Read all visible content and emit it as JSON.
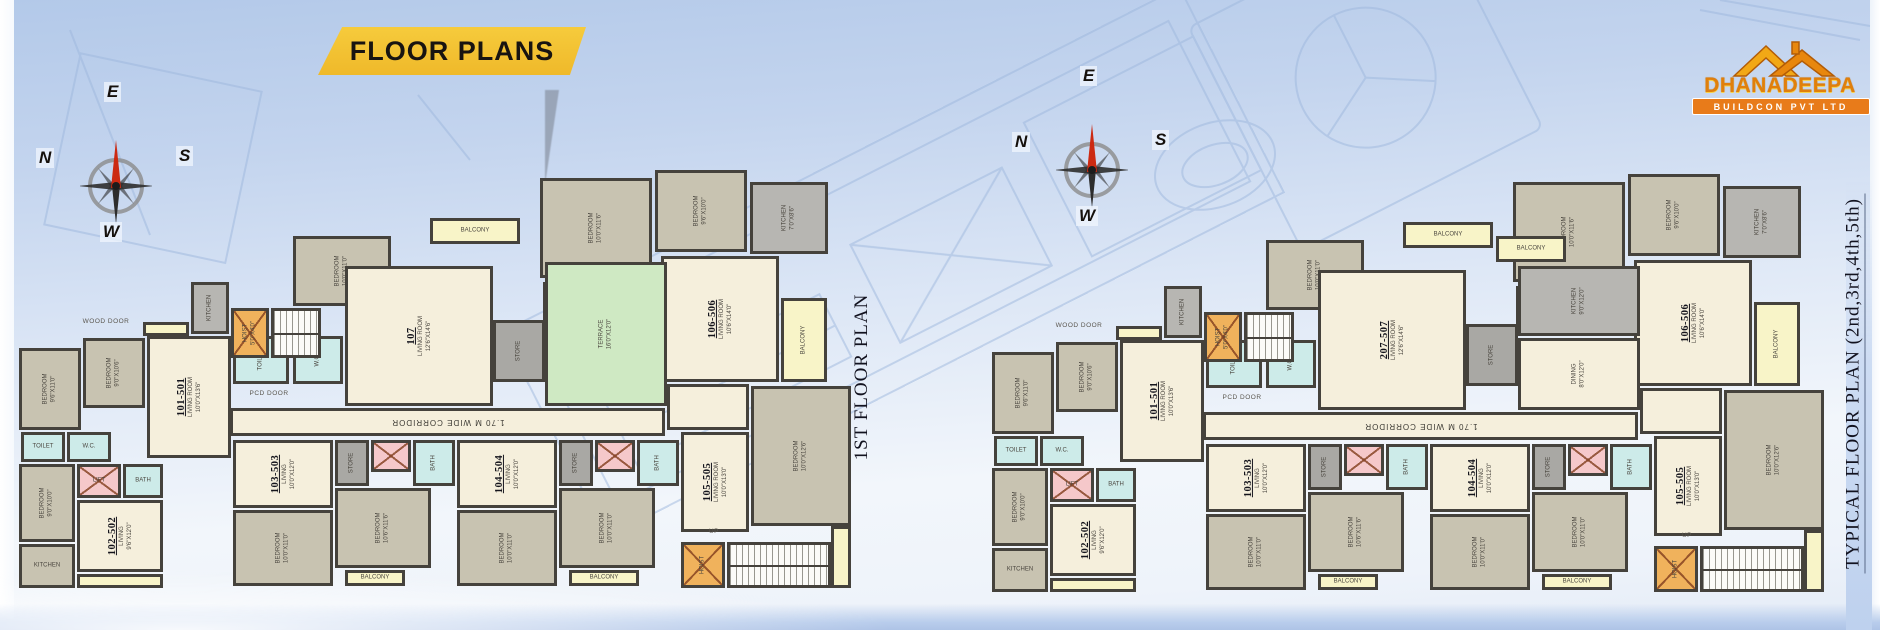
{
  "banner": {
    "label": "FLOOR PLANS"
  },
  "logo": {
    "name": "DHANADEEPA",
    "tagline": "BUILDCON PVT LTD"
  },
  "compass": {
    "top": "E",
    "left": "N",
    "right": "S",
    "bottom": "W"
  },
  "plans": [
    {
      "title": "1ST FLOOR PLAN",
      "variant": "first"
    },
    {
      "title": "TYPICAL FLOOR PLAN (2nd,3rd,4th,5th)",
      "variant": "typical"
    }
  ],
  "corridor_label": "1.70 M WIDE CORRIDOR",
  "colors": {
    "banner_bg": "#efb92a",
    "banner_fold": "#8d1f14",
    "logo_orange": "#e8820a",
    "wall": "#45423c",
    "living": "#f5efdc",
    "bedroom": "#c8c3b1",
    "toilet": "#cdebe9",
    "balcony": "#f8f4c8",
    "kitchen": "#b7b6b2",
    "terrace": "#cfe9c3",
    "lift": "#f5c8ca",
    "hoist": "#f0b25c",
    "compass_needle": "#cc2a12",
    "blueprint_line": "#9cb6dc"
  },
  "rooms": [
    {
      "x": 525,
      "y": 8,
      "w": 112,
      "h": 100,
      "t": "bedroom",
      "label": "BEDROOM",
      "dim": "10'0\"X11'6\"",
      "r": "v"
    },
    {
      "x": 640,
      "y": 0,
      "w": 92,
      "h": 82,
      "t": "bedroom",
      "label": "BEDROOM",
      "dim": "9'6\"X10'0\"",
      "r": "v"
    },
    {
      "x": 735,
      "y": 12,
      "w": 78,
      "h": 72,
      "t": "kitchen",
      "label": "KITCHEN",
      "dim": "7'0\"X8'6\"",
      "r": "v"
    },
    {
      "x": 528,
      "y": 112,
      "w": 56,
      "h": 46,
      "t": "toilet",
      "label": "TOILET",
      "r": "v"
    },
    {
      "x": 588,
      "y": 112,
      "w": 52,
      "h": 46,
      "t": "toilet",
      "label": "W.C.",
      "r": "v"
    },
    {
      "x": 646,
      "y": 86,
      "w": 118,
      "h": 126,
      "t": "living",
      "unit": "106-506",
      "label": "LIVING ROOM",
      "dim": "10'6\"X14'0\"",
      "r": "v"
    },
    {
      "x": 766,
      "y": 128,
      "w": 46,
      "h": 84,
      "t": "balcony",
      "label": "BALCONY",
      "r": "v"
    },
    {
      "x": 652,
      "y": 214,
      "w": 82,
      "h": 46,
      "t": "living"
    },
    {
      "x": 736,
      "y": 216,
      "w": 100,
      "h": 140,
      "t": "bedroom",
      "label": "BEDROOM",
      "dim": "10'0\"X12'6\"",
      "r": "v"
    },
    {
      "x": 415,
      "y": 48,
      "w": 90,
      "h": 26,
      "t": "balcony",
      "label": "BALCONY",
      "r": "h"
    },
    {
      "x": 278,
      "y": 66,
      "w": 98,
      "h": 70,
      "t": "bedroom",
      "label": "BEDROOM",
      "dim": "10'0\"X11'0\"",
      "r": "v"
    },
    {
      "x": 218,
      "y": 166,
      "w": 56,
      "h": 48,
      "t": "toilet",
      "label": "TOILET",
      "r": "v"
    },
    {
      "x": 278,
      "y": 166,
      "w": 50,
      "h": 48,
      "t": "toilet",
      "label": "W.C.",
      "r": "v"
    },
    {
      "x": 330,
      "y": 96,
      "w": 148,
      "h": 140,
      "t": "living",
      "unitv": {
        "first": "107",
        "typical": "207-507"
      },
      "label": "LIVING ROOM",
      "dim": "12'6\"X14'6\"",
      "r": "v"
    },
    {
      "x": 478,
      "y": 150,
      "w": 52,
      "h": 62,
      "t": "store",
      "label": "STORE",
      "r": "v"
    },
    {
      "x": 530,
      "y": 92,
      "w": 122,
      "h": 144,
      "t": "terrace",
      "label": "TERRACE",
      "dim": "16'0\"X12'0\"",
      "r": "v",
      "only": "first"
    },
    {
      "x": 530,
      "y": 92,
      "w": 122,
      "h": 70,
      "t": "kitchen",
      "label": "KITCHEN",
      "dim": "9'0\"X12'0\"",
      "r": "v",
      "only": "typical"
    },
    {
      "x": 530,
      "y": 164,
      "w": 122,
      "h": 72,
      "t": "living",
      "label": "DINING",
      "dim": "8'0\"X12'0\"",
      "r": "v",
      "only": "typical"
    },
    {
      "x": 508,
      "y": 62,
      "w": 70,
      "h": 26,
      "t": "balcony",
      "label": "BALCONY",
      "r": "h",
      "only": "typical"
    },
    {
      "x": 4,
      "y": 178,
      "w": 62,
      "h": 82,
      "t": "bedroom",
      "label": "BEDROOM",
      "dim": "9'6\"X11'0\"",
      "r": "v"
    },
    {
      "x": 68,
      "y": 168,
      "w": 62,
      "h": 70,
      "t": "bedroom",
      "label": "BEDROOM",
      "dim": "9'0\"X10'6\"",
      "r": "v"
    },
    {
      "x": 132,
      "y": 166,
      "w": 84,
      "h": 122,
      "t": "living",
      "unit": "101-501",
      "label": "LIVING ROOM",
      "dim": "10'0\"X13'6\"",
      "r": "v"
    },
    {
      "x": 128,
      "y": 152,
      "w": 46,
      "h": 14,
      "t": "balcony"
    },
    {
      "x": 176,
      "y": 112,
      "w": 38,
      "h": 52,
      "t": "kitchen",
      "label": "KITCHEN",
      "r": "v"
    },
    {
      "x": 216,
      "y": 138,
      "w": 38,
      "h": 50,
      "t": "hoist",
      "label": "HOIST",
      "dim": "5'0\"X4'0\"",
      "r": "v",
      "x2": true
    },
    {
      "x": 256,
      "y": 138,
      "w": 50,
      "h": 50,
      "t": "stair"
    },
    {
      "x": 6,
      "y": 262,
      "w": 44,
      "h": 30,
      "t": "toilet",
      "label": "TOILET",
      "r": "h"
    },
    {
      "x": 52,
      "y": 262,
      "w": 44,
      "h": 30,
      "t": "toilet",
      "label": "W.C.",
      "r": "h"
    },
    {
      "x": 4,
      "y": 294,
      "w": 56,
      "h": 78,
      "t": "bedroom",
      "label": "BEDROOM",
      "dim": "9'0\"X10'0\"",
      "r": "v"
    },
    {
      "x": 62,
      "y": 294,
      "w": 44,
      "h": 34,
      "t": "lift",
      "label": "LIFT",
      "r": "h",
      "x2": true
    },
    {
      "x": 108,
      "y": 294,
      "w": 40,
      "h": 34,
      "t": "toilet",
      "label": "BATH",
      "r": "h"
    },
    {
      "x": 62,
      "y": 330,
      "w": 86,
      "h": 72,
      "t": "living",
      "unit": "102-502",
      "label": "LIVING",
      "dim": "9'6\"X12'0\"",
      "r": "v"
    },
    {
      "x": 4,
      "y": 374,
      "w": 56,
      "h": 44,
      "t": "bedroom",
      "label": "KITCHEN",
      "r": "h"
    },
    {
      "x": 62,
      "y": 404,
      "w": 86,
      "h": 14,
      "t": "balcony"
    },
    {
      "x": 215,
      "y": 238,
      "w": 435,
      "h": 28,
      "t": "corridor",
      "bind": "corridor_label",
      "r": "u"
    },
    {
      "x": 218,
      "y": 270,
      "w": 100,
      "h": 68,
      "t": "living",
      "unit": "103-503",
      "label": "LIVING",
      "dim": "10'0\"X12'0\"",
      "r": "v"
    },
    {
      "x": 218,
      "y": 340,
      "w": 100,
      "h": 76,
      "t": "bedroom",
      "label": "BEDROOM",
      "dim": "10'0\"X11'0\"",
      "r": "v"
    },
    {
      "x": 320,
      "y": 270,
      "w": 34,
      "h": 46,
      "t": "store",
      "label": "STORE",
      "r": "v"
    },
    {
      "x": 356,
      "y": 270,
      "w": 40,
      "h": 32,
      "t": "lift",
      "x2": true
    },
    {
      "x": 398,
      "y": 270,
      "w": 42,
      "h": 46,
      "t": "toilet",
      "label": "BATH",
      "r": "v"
    },
    {
      "x": 320,
      "y": 318,
      "w": 96,
      "h": 80,
      "t": "bedroom",
      "label": "BEDROOM",
      "dim": "10'6\"X11'6\"",
      "r": "v"
    },
    {
      "x": 330,
      "y": 400,
      "w": 60,
      "h": 16,
      "t": "balcony",
      "label": "BALCONY",
      "r": "h"
    },
    {
      "x": 442,
      "y": 270,
      "w": 100,
      "h": 68,
      "t": "living",
      "unit": "104-504",
      "label": "LIVING",
      "dim": "10'0\"X12'0\"",
      "r": "v"
    },
    {
      "x": 442,
      "y": 340,
      "w": 100,
      "h": 76,
      "t": "bedroom",
      "label": "BEDROOM",
      "dim": "10'0\"X11'0\"",
      "r": "v"
    },
    {
      "x": 544,
      "y": 270,
      "w": 34,
      "h": 46,
      "t": "store",
      "label": "STORE",
      "r": "v"
    },
    {
      "x": 580,
      "y": 270,
      "w": 40,
      "h": 32,
      "t": "lift",
      "x2": true
    },
    {
      "x": 622,
      "y": 270,
      "w": 42,
      "h": 46,
      "t": "toilet",
      "label": "BATH",
      "r": "v"
    },
    {
      "x": 544,
      "y": 318,
      "w": 96,
      "h": 80,
      "t": "bedroom",
      "label": "BEDROOM",
      "dim": "10'0\"X11'0\"",
      "r": "v"
    },
    {
      "x": 554,
      "y": 400,
      "w": 70,
      "h": 16,
      "t": "balcony",
      "label": "BALCONY",
      "r": "h"
    },
    {
      "x": 666,
      "y": 262,
      "w": 68,
      "h": 100,
      "t": "living",
      "unit": "105-505",
      "label": "LIVING ROOM",
      "dim": "10'0\"X13'0\"",
      "r": "v"
    },
    {
      "x": 816,
      "y": 356,
      "w": 20,
      "h": 62,
      "t": "balcony"
    },
    {
      "x": 666,
      "y": 372,
      "w": 44,
      "h": 46,
      "t": "hoist",
      "label": "HOIST",
      "r": "v",
      "x2": true
    },
    {
      "x": 712,
      "y": 372,
      "w": 104,
      "h": 46,
      "t": "stair"
    },
    {
      "x": 222,
      "y": 218,
      "w": 64,
      "h": 12,
      "t": "note",
      "label": "PCD DOOR",
      "r": "h"
    },
    {
      "x": 58,
      "y": 146,
      "w": 66,
      "h": 12,
      "t": "note",
      "label": "WOOD DOOR",
      "r": "h"
    },
    {
      "x": 686,
      "y": 356,
      "w": 26,
      "h": 12,
      "t": "note",
      "label": "UP",
      "r": "h"
    }
  ]
}
